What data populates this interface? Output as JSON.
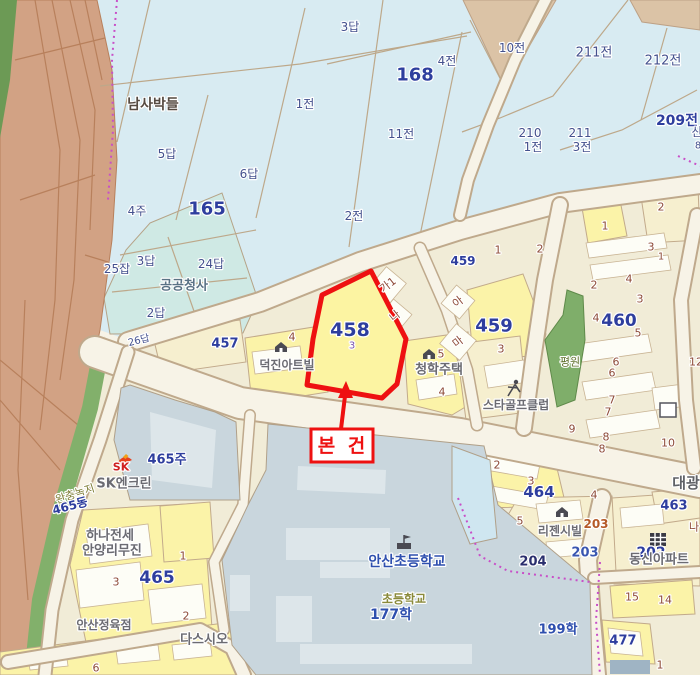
{
  "annotation": {
    "label": "본 건"
  },
  "subject": {
    "number": "458",
    "sub_number": "3"
  },
  "colors": {
    "highlight_red": "#ee1111",
    "farm_text": "#44518e",
    "parcel_number_blue": "#2e3e9e",
    "urban_number_brown": "#8e4b38",
    "road_fill": "#f7f3e7",
    "farm_fill": "#d8ebf2",
    "urban_fill": "#f1ecd7",
    "parcel_yellow": "#fbf3a8",
    "building_gray": "#c9d6dd",
    "green_belt": "#82b06b",
    "river_brown": "#d2a284",
    "govt_teal": "#cfe9e4"
  },
  "labels": [
    {
      "t": "남사박들",
      "x": 153,
      "y": 105,
      "c": "place"
    },
    {
      "t": "5답",
      "x": 167,
      "y": 154,
      "c": "farm"
    },
    {
      "t": "6답",
      "x": 249,
      "y": 174,
      "c": "farm"
    },
    {
      "t": "1전",
      "x": 305,
      "y": 104,
      "c": "farm"
    },
    {
      "t": "3답",
      "x": 350,
      "y": 27,
      "c": "farm"
    },
    {
      "t": "4전",
      "x": 447,
      "y": 61,
      "c": "farm"
    },
    {
      "t": "168",
      "x": 415,
      "y": 75,
      "c": "farmBold",
      "s": 18
    },
    {
      "t": "11전",
      "x": 401,
      "y": 134,
      "c": "farm"
    },
    {
      "t": "2전",
      "x": 354,
      "y": 216,
      "c": "farm"
    },
    {
      "t": "10전",
      "x": 512,
      "y": 48,
      "c": "farm"
    },
    {
      "t": "211전",
      "x": 594,
      "y": 53,
      "c": "farm",
      "s": 13
    },
    {
      "t": "212전",
      "x": 663,
      "y": 61,
      "c": "farm",
      "s": 13
    },
    {
      "t": "209전",
      "x": 677,
      "y": 121,
      "c": "farmBold",
      "s": 14
    },
    {
      "t": "210",
      "x": 530,
      "y": 133,
      "c": "farm"
    },
    {
      "t": "1전",
      "x": 533,
      "y": 147,
      "c": "farm"
    },
    {
      "t": "211",
      "x": 580,
      "y": 133,
      "c": "farm"
    },
    {
      "t": "3전",
      "x": 582,
      "y": 147,
      "c": "farm"
    },
    {
      "t": "산",
      "x": 697,
      "y": 132,
      "c": "farm"
    },
    {
      "t": "8",
      "x": 698,
      "y": 146,
      "c": "farm",
      "s": 10
    },
    {
      "t": "4주",
      "x": 137,
      "y": 211,
      "c": "farm"
    },
    {
      "t": "165",
      "x": 207,
      "y": 209,
      "c": "farmBold",
      "s": 18
    },
    {
      "t": "3답",
      "x": 146,
      "y": 261,
      "c": "farm"
    },
    {
      "t": "24답",
      "x": 211,
      "y": 264,
      "c": "farm"
    },
    {
      "t": "25잡",
      "x": 117,
      "y": 269,
      "c": "farm"
    },
    {
      "t": "공공청사",
      "x": 184,
      "y": 286,
      "c": "govt"
    },
    {
      "t": "2답",
      "x": 156,
      "y": 313,
      "c": "farm"
    },
    {
      "t": "26답",
      "x": 139,
      "y": 341,
      "c": "farmSmall",
      "r": -14
    },
    {
      "t": "457",
      "x": 225,
      "y": 344,
      "c": "pnum",
      "s": 13
    },
    {
      "t": "459",
      "x": 463,
      "y": 261,
      "c": "pnum",
      "s": 12
    },
    {
      "t": "459",
      "x": 494,
      "y": 326,
      "c": "pnum",
      "s": 18
    },
    {
      "t": "3",
      "x": 501,
      "y": 349,
      "c": "num"
    },
    {
      "t": "460",
      "x": 619,
      "y": 321,
      "c": "pnum",
      "s": 17
    },
    {
      "t": "5",
      "x": 638,
      "y": 333,
      "c": "num"
    },
    {
      "t": "464",
      "x": 539,
      "y": 492,
      "c": "pnum",
      "s": 15
    },
    {
      "t": "465",
      "x": 157,
      "y": 578,
      "c": "pnum",
      "s": 17
    },
    {
      "t": "465주",
      "x": 167,
      "y": 460,
      "c": "pnum",
      "s": 13
    },
    {
      "t": "463",
      "x": 674,
      "y": 506,
      "c": "pnum",
      "s": 13
    },
    {
      "t": "477",
      "x": 623,
      "y": 641,
      "c": "pnum",
      "s": 13
    },
    {
      "t": "202",
      "x": 651,
      "y": 553,
      "c": "pnum",
      "s": 14
    },
    {
      "t": "203",
      "x": 585,
      "y": 553,
      "c": "pnumLight",
      "s": 13
    },
    {
      "t": "203",
      "x": 596,
      "y": 524,
      "c": "numOrange"
    },
    {
      "t": "204",
      "x": 533,
      "y": 562,
      "c": "pnumDark",
      "s": 13
    },
    {
      "t": "199학",
      "x": 558,
      "y": 630,
      "c": "schoolBlue",
      "s": 13
    },
    {
      "t": "177학",
      "x": 391,
      "y": 615,
      "c": "schoolBlue",
      "s": 14
    },
    {
      "t": "안산초등학교",
      "x": 407,
      "y": 562,
      "c": "schoolBlue",
      "s": 14
    },
    {
      "t": "초등학교",
      "x": 404,
      "y": 599,
      "c": "oliveBold",
      "s": 12
    },
    {
      "t": "동신아파트",
      "x": 659,
      "y": 560,
      "c": "name",
      "s": 13
    },
    {
      "t": "리젠시빌",
      "x": 560,
      "y": 531,
      "c": "name"
    },
    {
      "t": "덕진아트빌",
      "x": 287,
      "y": 365,
      "c": "name"
    },
    {
      "t": "청학주택",
      "x": 439,
      "y": 370,
      "c": "name",
      "s": 13
    },
    {
      "t": "스타골프클럽",
      "x": 516,
      "y": 405,
      "c": "name"
    },
    {
      "t": "SK엔크린",
      "x": 124,
      "y": 484,
      "c": "name",
      "s": 13
    },
    {
      "t": "SK",
      "x": 121,
      "y": 467,
      "c": "skRed",
      "s": 11
    },
    {
      "t": "하나전세",
      "x": 110,
      "y": 536,
      "c": "name",
      "s": 13
    },
    {
      "t": "안양리무진",
      "x": 112,
      "y": 551,
      "c": "name",
      "s": 13
    },
    {
      "t": "안산정육점",
      "x": 104,
      "y": 625,
      "c": "name"
    },
    {
      "t": "다스시오",
      "x": 204,
      "y": 640,
      "c": "name",
      "s": 13
    },
    {
      "t": "완충녹지",
      "x": 75,
      "y": 494,
      "c": "olive",
      "r": -18
    },
    {
      "t": "465동",
      "x": 70,
      "y": 506,
      "c": "pnum",
      "s": 12,
      "r": -15
    },
    {
      "t": "평원",
      "x": 570,
      "y": 362,
      "c": "oliveGreen"
    },
    {
      "t": "대광",
      "x": 686,
      "y": 483,
      "c": "nameBig",
      "s": 15
    },
    {
      "t": "가1",
      "x": 388,
      "y": 285,
      "c": "num",
      "r": -38
    },
    {
      "t": "나",
      "x": 395,
      "y": 316,
      "c": "num",
      "r": -38
    },
    {
      "t": "아",
      "x": 458,
      "y": 302,
      "c": "num",
      "r": -38
    },
    {
      "t": "마",
      "x": 458,
      "y": 342,
      "c": "num",
      "r": -38
    },
    {
      "t": "1",
      "x": 498,
      "y": 250,
      "c": "num"
    },
    {
      "t": "2",
      "x": 540,
      "y": 249,
      "c": "num"
    },
    {
      "t": "2",
      "x": 661,
      "y": 207,
      "c": "num"
    },
    {
      "t": "1",
      "x": 605,
      "y": 226,
      "c": "num"
    },
    {
      "t": "3",
      "x": 651,
      "y": 247,
      "c": "num"
    },
    {
      "t": "1",
      "x": 661,
      "y": 257,
      "c": "num",
      "s": 10
    },
    {
      "t": "4",
      "x": 629,
      "y": 279,
      "c": "num"
    },
    {
      "t": "2",
      "x": 594,
      "y": 285,
      "c": "num"
    },
    {
      "t": "3",
      "x": 640,
      "y": 299,
      "c": "num"
    },
    {
      "t": "4",
      "x": 596,
      "y": 318,
      "c": "num"
    },
    {
      "t": "5",
      "x": 441,
      "y": 354,
      "c": "num"
    },
    {
      "t": "4",
      "x": 442,
      "y": 392,
      "c": "num"
    },
    {
      "t": "4",
      "x": 292,
      "y": 337,
      "c": "num"
    },
    {
      "t": "6",
      "x": 616,
      "y": 362,
      "c": "num"
    },
    {
      "t": "6",
      "x": 612,
      "y": 373,
      "c": "num"
    },
    {
      "t": "7",
      "x": 612,
      "y": 400,
      "c": "num"
    },
    {
      "t": "7",
      "x": 608,
      "y": 412,
      "c": "num"
    },
    {
      "t": "9",
      "x": 572,
      "y": 429,
      "c": "num"
    },
    {
      "t": "8",
      "x": 606,
      "y": 437,
      "c": "num"
    },
    {
      "t": "8",
      "x": 602,
      "y": 449,
      "c": "num"
    },
    {
      "t": "10",
      "x": 668,
      "y": 443,
      "c": "num"
    },
    {
      "t": "2",
      "x": 497,
      "y": 465,
      "c": "num"
    },
    {
      "t": "3",
      "x": 531,
      "y": 481,
      "c": "num"
    },
    {
      "t": "4",
      "x": 594,
      "y": 495,
      "c": "num"
    },
    {
      "t": "5",
      "x": 520,
      "y": 521,
      "c": "num"
    },
    {
      "t": "15",
      "x": 632,
      "y": 597,
      "c": "num"
    },
    {
      "t": "14",
      "x": 665,
      "y": 600,
      "c": "num"
    },
    {
      "t": "1",
      "x": 660,
      "y": 665,
      "c": "num"
    },
    {
      "t": "3",
      "x": 116,
      "y": 582,
      "c": "num"
    },
    {
      "t": "1",
      "x": 183,
      "y": 556,
      "c": "num"
    },
    {
      "t": "2",
      "x": 186,
      "y": 616,
      "c": "num"
    },
    {
      "t": "6",
      "x": 96,
      "y": 668,
      "c": "num"
    },
    {
      "t": "나",
      "x": 694,
      "y": 527,
      "c": "num"
    },
    {
      "t": "12",
      "x": 696,
      "y": 362,
      "c": "num"
    }
  ],
  "icons": [
    {
      "name": "dukjin-building-icon",
      "sym": "building",
      "x": 281,
      "y": 348
    },
    {
      "name": "chunghak-building-icon",
      "sym": "building",
      "x": 429,
      "y": 355
    },
    {
      "name": "regency-building-icon",
      "sym": "building",
      "x": 562,
      "y": 513
    },
    {
      "name": "school-icon",
      "sym": "school",
      "x": 404,
      "y": 544
    },
    {
      "name": "apartment-icon",
      "sym": "apartment",
      "x": 658,
      "y": 540
    },
    {
      "name": "golf-icon",
      "sym": "golfer",
      "x": 513,
      "y": 389
    },
    {
      "name": "sk-logo-icon",
      "sym": "sk",
      "x": 124,
      "y": 461
    },
    {
      "name": "building-outline-icon",
      "sym": "square",
      "x": 668,
      "y": 410
    }
  ]
}
